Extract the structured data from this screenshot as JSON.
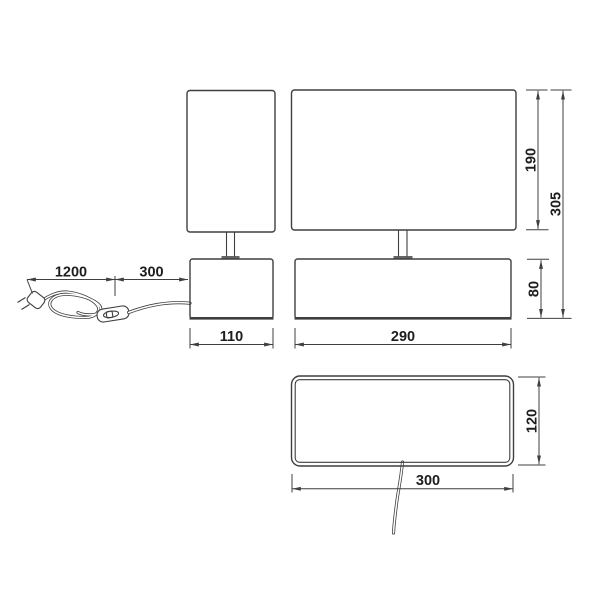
{
  "drawing": {
    "colors": {
      "background": "#ffffff",
      "line": "#3f3f3f",
      "text": "#1d1d1d"
    },
    "dimensions": {
      "cord_length": "1200",
      "cord_to_lamp": "300",
      "small_base_width": "110",
      "large_base_width": "290",
      "shade_height": "190",
      "total_height": "305",
      "base_height": "80",
      "top_view_depth": "120",
      "top_view_width": "300"
    }
  }
}
